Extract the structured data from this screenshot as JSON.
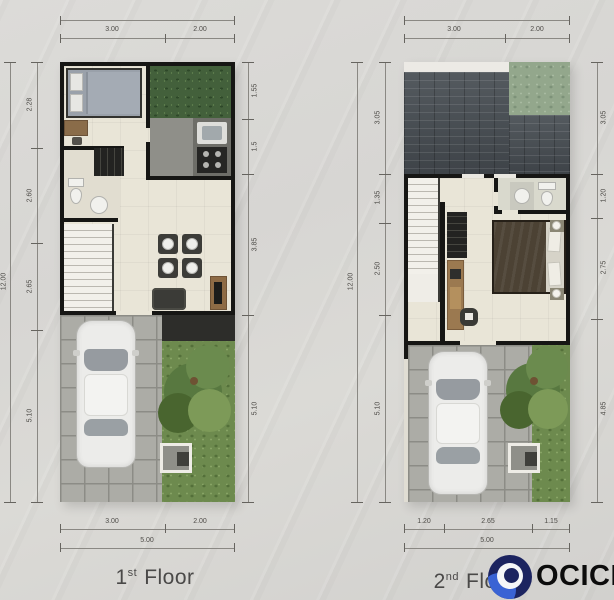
{
  "plans": [
    {
      "caption": {
        "number": "1",
        "suffix": "st",
        "word": "Floor"
      },
      "dims": {
        "top": [
          "3.00",
          "2.00"
        ],
        "left_total": "12.00",
        "left": [
          "2.28",
          "2.60",
          "2.65",
          "5.10"
        ],
        "right": [
          "1.55",
          "1.5",
          "3.85",
          "5.10"
        ],
        "bottom": [
          "3.00",
          "2.00"
        ],
        "bottom_total": "5.00"
      }
    },
    {
      "caption": {
        "number": "2",
        "suffix": "nd",
        "word": "Floor"
      },
      "dims": {
        "top": [
          "3.00",
          "2.00"
        ],
        "left_total": "12.00",
        "left": [
          "3.05",
          "1.35",
          "2.50",
          "5.10"
        ],
        "right": [
          "3.05",
          "1.20",
          "2.75",
          "4.85"
        ],
        "bottom": [
          "1.20",
          "2.65",
          "1.15"
        ],
        "bottom_total": "5.00"
      }
    }
  ],
  "watermark": {
    "text": "OCICIO",
    "circle_navy": "#1c2460",
    "circle_blue": "#3a63d4",
    "text_color": "#0c0c0c"
  }
}
